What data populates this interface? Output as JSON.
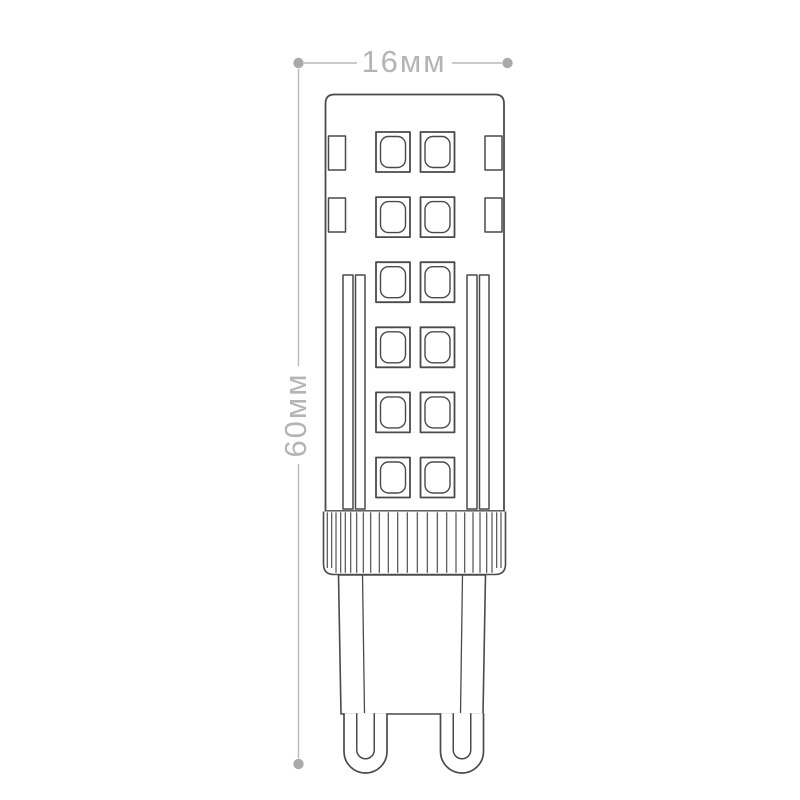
{
  "page": {
    "background_color": "#ffffff"
  },
  "diagram": {
    "subject": "G9 LED capsule lamp dimensional line drawing",
    "outline_color": "#4a4a4a",
    "dimension_line_color": "#b7baba",
    "dimension_dot_color": "#a9abab",
    "dimension_text_color": "#b3b5b5",
    "dimension_labels": {
      "width": "16мм",
      "height": "60мм"
    },
    "features": {
      "front_led_rows": 6,
      "front_led_columns": 2,
      "side_led_rows": 2,
      "pin_count": 2
    }
  }
}
